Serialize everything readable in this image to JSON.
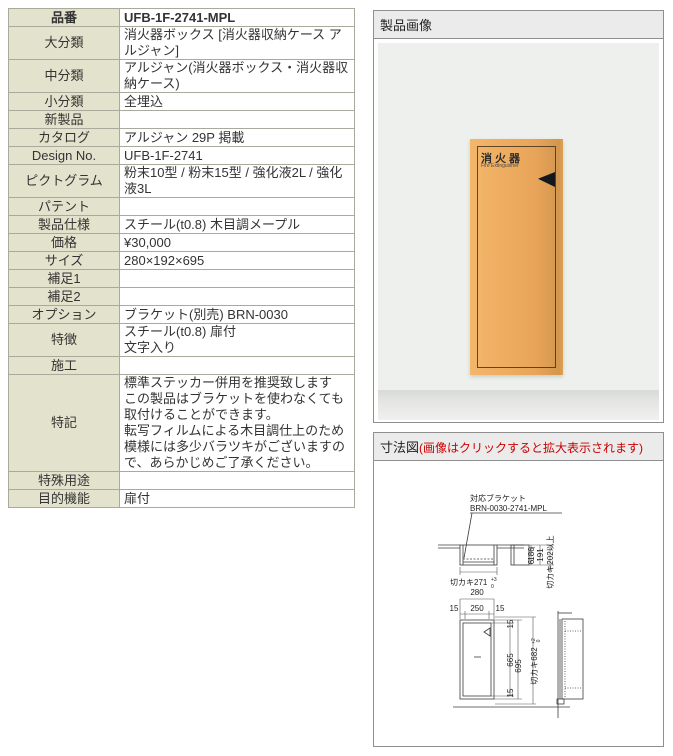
{
  "table": {
    "rows": [
      {
        "label": "品番",
        "value": "UFB-1F-2741-MPL"
      },
      {
        "label": "大分類",
        "value": "消火器ボックス [消火器収納ケース アルジャン]"
      },
      {
        "label": "中分類",
        "value": "アルジャン(消火器ボックス・消火器収納ケース)"
      },
      {
        "label": "小分類",
        "value": "全埋込"
      },
      {
        "label": "新製品",
        "value": ""
      },
      {
        "label": "カタログ",
        "value": "アルジャン 29P 掲載"
      },
      {
        "label": "Design No.",
        "value": "UFB-1F-2741"
      },
      {
        "label": "ピクトグラム",
        "value": "粉末10型 / 粉末15型 / 強化液2L / 強化液3L"
      },
      {
        "label": "パテント",
        "value": ""
      },
      {
        "label": "製品仕様",
        "value": "スチール(t0.8) 木目調メープル"
      },
      {
        "label": "価格",
        "value": "¥30,000"
      },
      {
        "label": "サイズ",
        "value": "280×192×695"
      },
      {
        "label": "補足1",
        "value": ""
      },
      {
        "label": "補足2",
        "value": ""
      },
      {
        "label": "オプション",
        "value": "ブラケット(別売) BRN-0030"
      },
      {
        "label": "特徴",
        "value": "スチール(t0.8) 扉付\n文字入り"
      },
      {
        "label": "施工",
        "value": ""
      },
      {
        "label": "特記",
        "value": "標準ステッカー併用を推奨致します\nこの製品はブラケットを使わなくても取付けることができます。\n転写フィルムによる木目調仕上のため模様には多少バラツキがございますので、あらかじめご了承ください。"
      },
      {
        "label": "特殊用途",
        "value": ""
      },
      {
        "label": "目的機能",
        "value": "扉付"
      }
    ]
  },
  "image_panel": {
    "title": "製品画像",
    "box_label": "消火器",
    "box_label_en": "Fire Extinguisher"
  },
  "dim_panel": {
    "title": "寸法図",
    "note": "(画像はクリックすると拡大表示されます)"
  },
  "dim": {
    "bracket_line1": "対応ブラケット",
    "bracket_line2": "BRN-0030-2741-MPL",
    "cut_width": "切カキ271",
    "cut_width_tol_plus": "+3",
    "cut_width_tol_zero": "0",
    "d6": "6",
    "d186": "186",
    "d191": "191",
    "cut_depth": "切カキ202以上",
    "w280": "280",
    "w15l": "15",
    "w250": "250",
    "w15r": "15",
    "h15t": "15",
    "h665": "665",
    "h695": "695",
    "h15b": "15",
    "cut_height": "切カキ682",
    "cut_height_tol_plus": "+2",
    "cut_height_tol_zero": "0"
  },
  "colors": {
    "label_bg": "#e3e3cd",
    "panel_header_bg": "#ebebeb",
    "note_red": "#cc0000",
    "wood": "#e9a85c",
    "photo_bg": "#eef0ed"
  }
}
